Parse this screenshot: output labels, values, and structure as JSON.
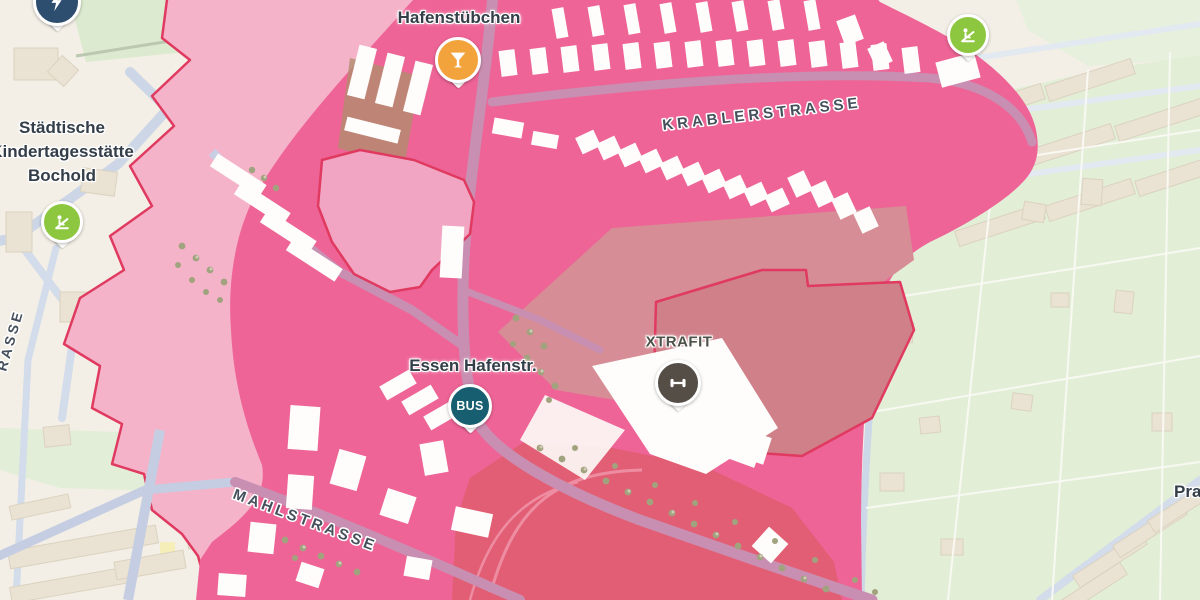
{
  "map": {
    "street_labels": {
      "krablerstrasse": "KRABLERSTRASSE",
      "mahlstrasse": "MAHLSTRASSE",
      "left_edge_partial": "RASSE",
      "bottom_right_partial": "Pra"
    },
    "poi_labels": {
      "hafenstuebchen": "Hafenstübchen",
      "kindergarten": {
        "line1": "Städtische",
        "line2": "Kindertagesstätte",
        "line3": "Bochold"
      },
      "bus_stop": "Essen Hafenstr.",
      "gym": "XTRAFIT"
    },
    "markers": {
      "bus": {
        "label": "BUS",
        "color": "#175f70",
        "icon": "bus-stop"
      },
      "cocktail": {
        "color": "#f2a33c",
        "icon": "cocktail-glass"
      },
      "playground_west": {
        "color": "#8dc63f",
        "icon": "playground"
      },
      "playground_northeast": {
        "color": "#8dc63f",
        "icon": "playground"
      },
      "gym": {
        "color": "#544e46",
        "icon": "dumbbell"
      },
      "partial_top_left": {
        "color": "#2e4e6f",
        "icon": "lightning-bolt"
      }
    },
    "zone_colors": {
      "primary_pink": "#ee6496",
      "light_pink": "#f5b3ca",
      "border_crimson": "#e03a60",
      "dark_red": "#e25e74",
      "dusty_rose": "#d68d95"
    }
  }
}
